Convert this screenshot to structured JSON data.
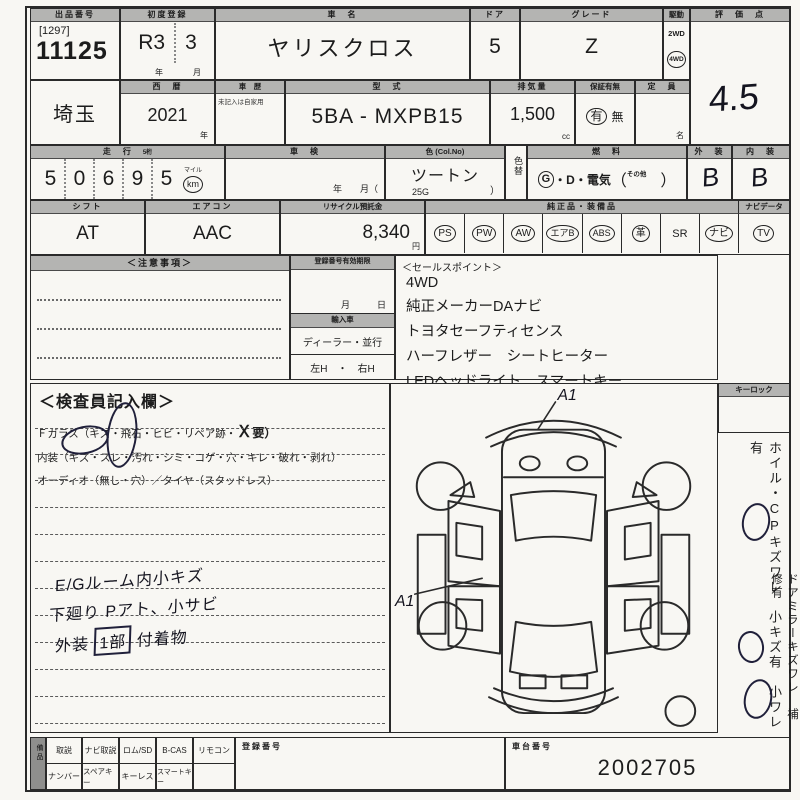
{
  "sheet": {
    "lot_label": "出品番号",
    "lot_bracket": "[1297]",
    "lot_number": "11125",
    "firstreg_label": "初度登録",
    "firstreg_year": "R3",
    "firstreg_month": "3",
    "firstreg_year_unit": "年",
    "firstreg_month_unit": "月",
    "carname_label": "車　名",
    "carname": "ヤリスクロス",
    "door_label": "ドア",
    "door": "5",
    "grade_label": "グレード",
    "grade": "Z",
    "drive_label": "駆動",
    "drive_2wd": "2WD",
    "drive_4wd": "4WD",
    "score_label": "評　価　点",
    "score": "4.5",
    "region": "埼玉",
    "year_label": "西　暦",
    "year": "2021",
    "year_unit": "年",
    "history_label": "車　歴",
    "history_note": "未記入は自家用",
    "model_label": "型　式",
    "model": "5BA - MXPB15",
    "disp_label": "排気量",
    "disp": "1,500",
    "disp_unit": "cc",
    "warranty_label": "保証有無",
    "warranty_yes": "有",
    "warranty_no": "無",
    "capacity_label": "定　員",
    "capacity_unit": "名",
    "mileage_label": "走　行",
    "mileage_note": "5桁",
    "mileage_digits": [
      "5",
      "0",
      "6",
      "9",
      "5"
    ],
    "mileage_mile": "マイル",
    "mileage_km": "km",
    "shaken_label": "車　検",
    "shaken_units": "年　　月（",
    "color_label": "色 (Col.No)",
    "color": "ツートン",
    "color_code": "25G",
    "color_close": "）",
    "colorchg_label": "色替",
    "fuel_label": "燃　料",
    "fuel_g": "G",
    "fuel_rest": "・D・電気",
    "fuel_open": "（",
    "fuel_other": "その他",
    "fuel_close": "）",
    "ext_label": "外　装",
    "ext": "B",
    "int_label": "内　装",
    "int": "B",
    "shift_label": "シフト",
    "shift": "AT",
    "aircon_label": "エアコン",
    "aircon": "AAC",
    "recycle_label": "リサイクル預託金",
    "recycle": "8,340",
    "recycle_unit": "円",
    "equip_label": "純正品・装備品",
    "equip_nav_label": "ナビデータ",
    "equip_items": [
      {
        "t": "PS",
        "circled": true
      },
      {
        "t": "PW",
        "circled": true
      },
      {
        "t": "AW",
        "circled": true
      },
      {
        "t": "エアB",
        "circled": true
      },
      {
        "t": "ABS",
        "circled": true
      },
      {
        "t": "革",
        "circled": true
      },
      {
        "t": "SR",
        "circled": false
      },
      {
        "t": "ナビ",
        "circled": true
      },
      {
        "t": "TV",
        "circled": true
      }
    ]
  },
  "middle": {
    "notice_label": "＜注意事項＞",
    "validity_label": "登録番号有効期限",
    "validity_units": "月　　　日",
    "import_label": "輸入車",
    "dealer": "ディーラー・並行",
    "handle": "左H　・　右H",
    "sales_label": "＜セールスポイント＞",
    "sales": [
      "4WD",
      "純正メーカーDAナビ",
      "トヨタセーフティセンス",
      "ハーフレザー　シートヒーター",
      "LEDヘッドライト　スマートキー"
    ]
  },
  "inspector": {
    "title": "＜検査員記入欄＞",
    "line1_pre": "Ｆガラス（キズ・飛石・ヒビ・リペア跡・",
    "line1_mark": "Ｘ",
    "line1_post": "要）",
    "line2": "内装（キズ・スレ・汚れ・シミ・コゲ・穴・キレ・破れ・剥れ）",
    "line3": "オーディオ（無し・穴）／タイヤ（スタッドレス）",
    "notes": [
      "E/Gルーム内小キズ",
      "下廻り Pアト、小サビ"
    ],
    "note3_pre": "外装",
    "note3_boxed": "1部",
    "note3_post": "付着物"
  },
  "diagram": {
    "mark_top": "A1",
    "mark_left": "A1"
  },
  "sidebar": {
    "keylock_label": "キーロック",
    "col1": "ホイル・CPキズワレ　小キズ有　小ワレ有",
    "col2": "ドアミラーキズワレ　補修有"
  },
  "bottom": {
    "side_label": "備品",
    "row1": [
      "取説",
      "ナビ取説",
      "ロム/SD",
      "B-CAS",
      "リモコン"
    ],
    "row2": [
      "ナンバー",
      "スペアキー",
      "キーレス",
      "スマートキー"
    ],
    "reg_label": "登録番号",
    "chassis_label": "車台番号",
    "chassis": "2002705"
  },
  "colors": {
    "line": "#2a2a2a",
    "header_bg": "#b4b4b2",
    "paper": "#f8f7f3",
    "handwriting": "#14141f"
  }
}
